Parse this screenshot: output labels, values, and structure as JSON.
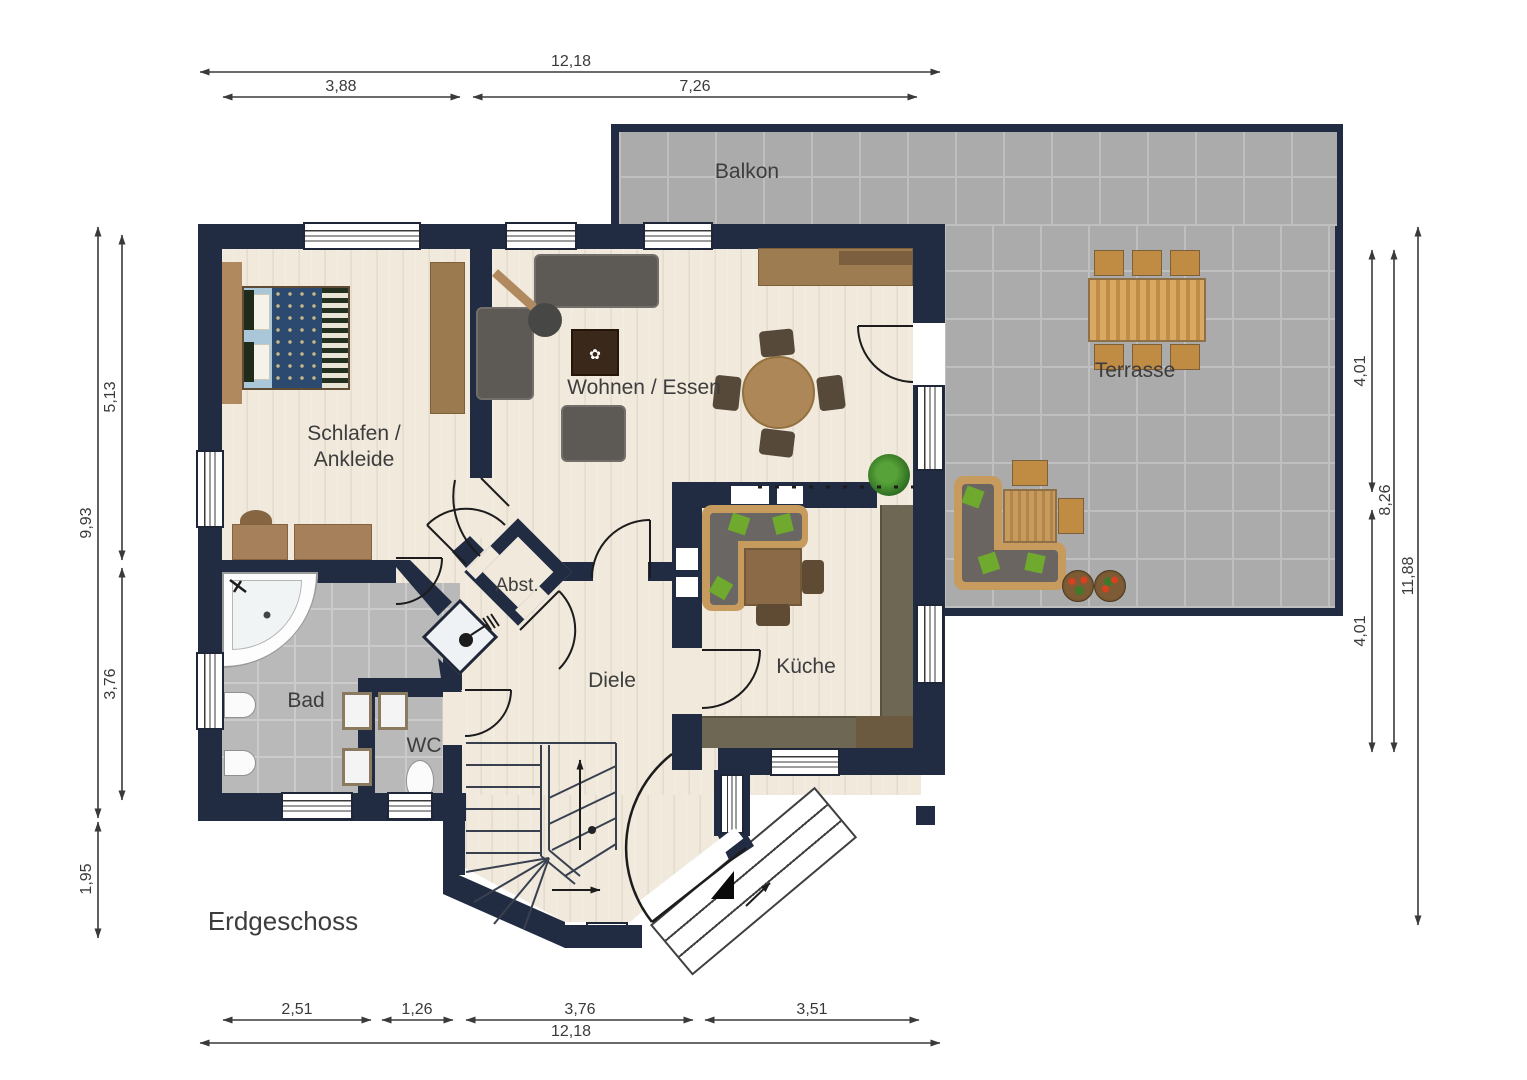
{
  "plan": {
    "floor_label": "Erdgeschoss",
    "rooms": {
      "balkon": "Balkon",
      "terrasse": "Terrasse",
      "wohnen_essen": "Wohnen / Essen",
      "schlafen_line1": "Schlafen /",
      "schlafen_line2": "Ankleide",
      "abstellraum": "Abst.",
      "diele": "Diele",
      "kueche": "Küche",
      "bad": "Bad",
      "wc": "WC"
    }
  },
  "dimensions": {
    "top": {
      "total": "12,18",
      "left": "3,88",
      "right": "7,26"
    },
    "bottom": {
      "a": "2,51",
      "b": "1,26",
      "c": "3,76",
      "d": "3,51",
      "total": "12,18"
    },
    "left": {
      "outer_main": "9,93",
      "upper": "5,13",
      "lower": "3,76",
      "bay": "1,95"
    },
    "right": {
      "upper": "4,01",
      "mid": "8,26",
      "lower": "4,01",
      "outer": "11,88"
    }
  },
  "colors": {
    "wall": "#212b42",
    "floor_wood": "#f0e9dc",
    "tile_outdoor": "#ababab",
    "tile_bath": "#b9b9b9",
    "counter": "#6e6754",
    "wood_furniture": "#c79a5e",
    "dimension_text": "#3a3a3a",
    "label_text": "#3d3d3d"
  }
}
